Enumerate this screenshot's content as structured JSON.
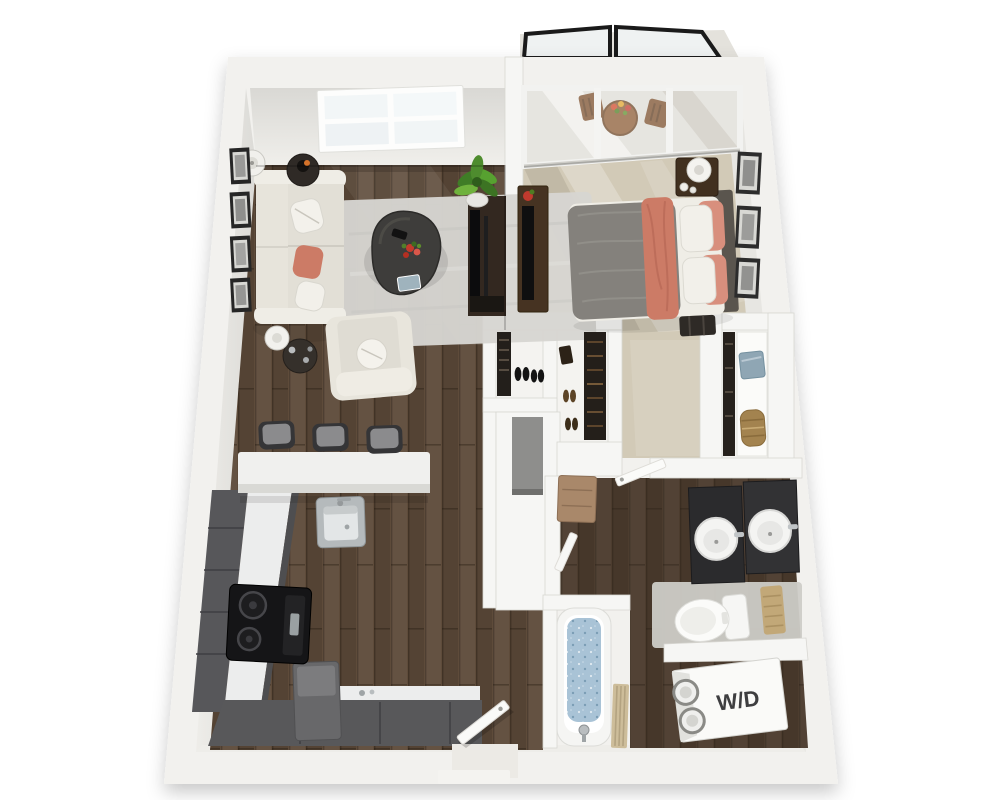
{
  "meta": {
    "alt": "3D rendered floor plan of a one-bedroom, one-bathroom apartment with balcony, seen from above"
  },
  "labels": {
    "washer_dryer": "W/D"
  },
  "palette": {
    "background": "#ffffff",
    "wall": "#f2f1ee",
    "wall_face": "#e7e6e2",
    "wood": "#5e4b3a",
    "wood_dark": "#4c3c2e",
    "carpet": "#d2cab7",
    "rug": "#d6d5d1",
    "sofa": "#e7e4db",
    "coral_accent": "#cc7b66",
    "counter": "#f0f0ee",
    "cabinets": "#57575a",
    "vanity": "#2b2b2d",
    "tub_water": "#a9c3d6",
    "plant_green": "#4e8c2e",
    "railing": "#1a1a1a",
    "towel": "#c2a878",
    "wd_text": "#3e3e40"
  }
}
